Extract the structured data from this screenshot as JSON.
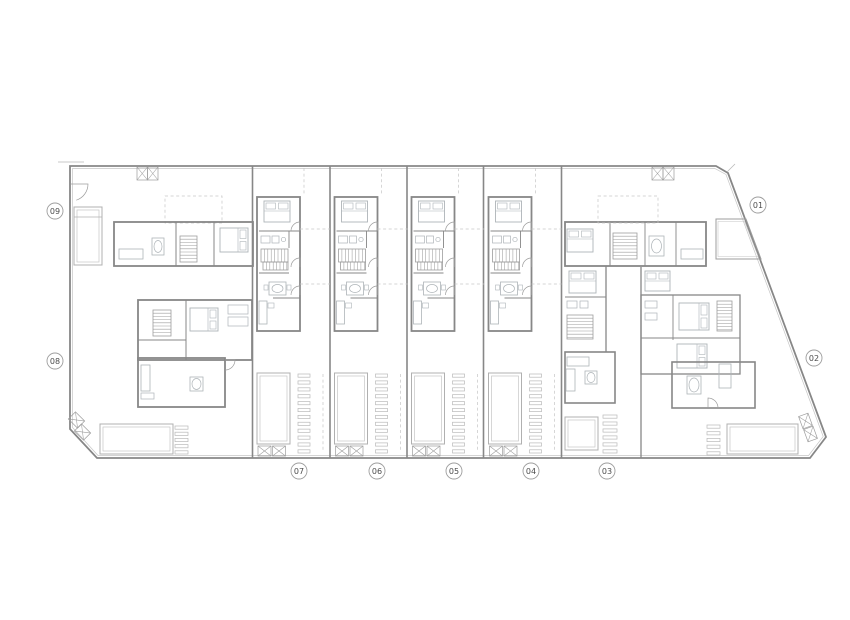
{
  "document": {
    "type": "architectural-floor-plan",
    "description": "Site plan of nine dwellings with pools, circled unit numbers around perimeter"
  },
  "colors": {
    "bg": "#ffffff",
    "W": "#878787",
    "M": "#9d9d9d",
    "L": "#b9b9b9",
    "F": "#aeb4b8",
    "D": "#c6c6c6",
    "P": "#b0b0b0",
    "T": "#4c4c4c"
  },
  "labels": [
    {
      "id": "01",
      "x": 758,
      "y": 205
    },
    {
      "id": "02",
      "x": 814,
      "y": 358
    },
    {
      "id": "03",
      "x": 607,
      "y": 471
    },
    {
      "id": "04",
      "x": 531,
      "y": 471
    },
    {
      "id": "05",
      "x": 454,
      "y": 471
    },
    {
      "id": "06",
      "x": 377,
      "y": 471
    },
    {
      "id": "07",
      "x": 299,
      "y": 471
    },
    {
      "id": "08",
      "x": 55,
      "y": 361
    },
    {
      "id": "09",
      "x": 55,
      "y": 211
    }
  ],
  "plan": {
    "strips": [
      253,
      330.5,
      407.5,
      484.5
    ],
    "statics": [
      {
        "t": "poly",
        "pts": [
          [
            70,
            166
          ],
          [
            716,
            166
          ],
          [
            728,
            173
          ],
          [
            826,
            437
          ],
          [
            810,
            458
          ],
          [
            97,
            458
          ],
          [
            70,
            429
          ]
        ],
        "c": "W",
        "sw": 1.8
      },
      {
        "t": "poly",
        "pts": [
          [
            72.5,
            168.5
          ],
          [
            714.8,
            168.5
          ],
          [
            726,
            174.5
          ],
          [
            823.2,
            436.5
          ],
          [
            808.6,
            455.5
          ],
          [
            98,
            455.5
          ],
          [
            72.5,
            427.5
          ]
        ],
        "c": "D",
        "sw": 0.7
      },
      {
        "t": "line",
        "x1": 58,
        "y1": 162,
        "x2": 84,
        "y2": 162,
        "c": "L",
        "sw": 0.8
      },
      {
        "t": "line",
        "x1": 727,
        "y1": 172,
        "x2": 735,
        "y2": 164,
        "c": "L",
        "sw": 0.8
      },
      {
        "t": "line",
        "x1": 252.5,
        "y1": 166,
        "x2": 252.5,
        "y2": 458,
        "c": "W",
        "sw": 1.6
      },
      {
        "t": "line",
        "x1": 330,
        "y1": 166,
        "x2": 330,
        "y2": 458,
        "c": "W",
        "sw": 1.6
      },
      {
        "t": "line",
        "x1": 407,
        "y1": 166,
        "x2": 407,
        "y2": 458,
        "c": "W",
        "sw": 1.6
      },
      {
        "t": "line",
        "x1": 483.5,
        "y1": 166,
        "x2": 483.5,
        "y2": 458,
        "c": "W",
        "sw": 1.6
      },
      {
        "t": "line",
        "x1": 561.5,
        "y1": 166,
        "x2": 561.5,
        "y2": 458,
        "c": "W",
        "sw": 1.6
      },
      {
        "t": "line",
        "x1": 641,
        "y1": 267,
        "x2": 641,
        "y2": 458,
        "c": "W",
        "sw": 1.3
      },
      {
        "t": "xbox",
        "x": 137,
        "y": 167,
        "w": 10.5,
        "h": 13
      },
      {
        "t": "xbox",
        "x": 147.5,
        "y": 167,
        "w": 10.5,
        "h": 13
      },
      {
        "t": "xbox",
        "x": 652,
        "y": 167,
        "w": 11,
        "h": 13
      },
      {
        "t": "xbox",
        "x": 663,
        "y": 167,
        "w": 11,
        "h": 13
      },
      {
        "t": "pool",
        "x": 74,
        "y": 207,
        "w": 28,
        "h": 58
      },
      {
        "t": "line",
        "x1": 74,
        "y1": 217,
        "x2": 102,
        "y2": 217,
        "c": "P",
        "sw": 0.8
      },
      {
        "t": "door",
        "hx": 71,
        "hy": 184,
        "r": 17,
        "a0": 0,
        "a1": 72,
        "s": 1
      },
      {
        "t": "drect",
        "x": 165,
        "y": 196,
        "w": 57,
        "h": 27
      },
      {
        "t": "rect",
        "x": 114,
        "y": 222,
        "w": 139,
        "h": 44,
        "c": "W",
        "sw": 1.8
      },
      {
        "t": "line",
        "x1": 176,
        "y1": 222,
        "x2": 176,
        "y2": 266,
        "c": "W",
        "sw": 1
      },
      {
        "t": "line",
        "x1": 214,
        "y1": 222,
        "x2": 214,
        "y2": 266,
        "c": "W",
        "sw": 1
      },
      {
        "t": "bed",
        "x": 220,
        "y": 228,
        "w": 28,
        "h": 24,
        "p": "r"
      },
      {
        "t": "hatch",
        "x": 180,
        "y": 236,
        "w": 17,
        "h": 26,
        "step": 3.2,
        "dir": "h"
      },
      {
        "t": "rect",
        "x": 119,
        "y": 249,
        "w": 24,
        "h": 10,
        "c": "F",
        "sw": 0.8
      },
      {
        "t": "rect",
        "x": 152,
        "y": 238,
        "w": 12,
        "h": 17,
        "c": "F",
        "sw": 0.8
      },
      {
        "t": "ell",
        "cx": 158,
        "cy": 246.5,
        "rx": 4,
        "ry": 6,
        "c": "F",
        "sw": 0.7
      },
      {
        "t": "rect",
        "x": 138,
        "y": 300,
        "w": 114,
        "h": 60,
        "c": "W",
        "sw": 1.8
      },
      {
        "t": "rect",
        "x": 138,
        "y": 358,
        "w": 87,
        "h": 49,
        "c": "W",
        "sw": 1.8
      },
      {
        "t": "hatch",
        "x": 153,
        "y": 310,
        "w": 18,
        "h": 26,
        "step": 3.2,
        "dir": "h"
      },
      {
        "t": "bed",
        "x": 190,
        "y": 308,
        "w": 28,
        "h": 23,
        "p": "r"
      },
      {
        "t": "line",
        "x1": 186,
        "y1": 300,
        "x2": 186,
        "y2": 360,
        "c": "W",
        "sw": 1
      },
      {
        "t": "line",
        "x1": 138,
        "y1": 340,
        "x2": 186,
        "y2": 340,
        "c": "W",
        "sw": 1
      },
      {
        "t": "rect",
        "x": 228,
        "y": 305,
        "w": 20,
        "h": 9,
        "c": "F",
        "sw": 0.7
      },
      {
        "t": "rect",
        "x": 228,
        "y": 317,
        "w": 20,
        "h": 9,
        "c": "F",
        "sw": 0.7
      },
      {
        "t": "rect",
        "x": 141,
        "y": 365,
        "w": 9,
        "h": 26,
        "c": "F",
        "sw": 0.8
      },
      {
        "t": "rect",
        "x": 141,
        "y": 393,
        "w": 13,
        "h": 6,
        "c": "F",
        "sw": 0.7
      },
      {
        "t": "rect",
        "x": 190,
        "y": 377,
        "w": 13,
        "h": 14,
        "c": "F",
        "sw": 0.8
      },
      {
        "t": "ell",
        "cx": 196.5,
        "cy": 384,
        "rx": 4.5,
        "ry": 5.5,
        "c": "F",
        "sw": 0.7
      },
      {
        "t": "door",
        "hx": 225,
        "hy": 360,
        "r": 10,
        "a0": 0,
        "a1": 90,
        "s": 1
      },
      {
        "t": "pool",
        "x": 100,
        "y": 424,
        "w": 73,
        "h": 30
      },
      {
        "t": "slats",
        "x": 175,
        "y": 426,
        "w": 13,
        "h": 28,
        "n": 5
      },
      {
        "t": "xbox",
        "x": 70,
        "y": 415,
        "w": 13,
        "h": 10,
        "rot": 45
      },
      {
        "t": "xbox",
        "x": 76,
        "y": 427,
        "w": 13,
        "h": 10,
        "rot": 45
      },
      {
        "t": "rect",
        "x": 565,
        "y": 222,
        "w": 141,
        "h": 44,
        "c": "W",
        "sw": 1.8
      },
      {
        "t": "bed",
        "x": 567,
        "y": 229,
        "w": 26,
        "h": 23,
        "p": "t"
      },
      {
        "t": "line",
        "x1": 610,
        "y1": 222,
        "x2": 610,
        "y2": 266,
        "c": "W",
        "sw": 1
      },
      {
        "t": "hatch",
        "x": 613,
        "y": 233,
        "w": 24,
        "h": 26,
        "step": 3.2,
        "dir": "h"
      },
      {
        "t": "line",
        "x1": 645,
        "y1": 222,
        "x2": 645,
        "y2": 266,
        "c": "W",
        "sw": 0.9
      },
      {
        "t": "rect",
        "x": 649,
        "y": 236,
        "w": 15,
        "h": 20,
        "c": "F",
        "sw": 0.8
      },
      {
        "t": "ell",
        "cx": 656.5,
        "cy": 246,
        "rx": 5,
        "ry": 7,
        "c": "F",
        "sw": 0.7
      },
      {
        "t": "line",
        "x1": 676,
        "y1": 222,
        "x2": 676,
        "y2": 266,
        "c": "W",
        "sw": 0.9
      },
      {
        "t": "rect",
        "x": 681,
        "y": 249,
        "w": 22,
        "h": 10,
        "c": "F",
        "sw": 0.8
      },
      {
        "t": "poly",
        "pts": [
          [
            716,
            219
          ],
          [
            746,
            219
          ],
          [
            761,
            259
          ],
          [
            716,
            259
          ]
        ],
        "c": "M",
        "sw": 1
      },
      {
        "t": "poly",
        "pts": [
          [
            718,
            221.5
          ],
          [
            744.6,
            221.5
          ],
          [
            758.2,
            256.5
          ],
          [
            718,
            256.5
          ]
        ],
        "c": "D",
        "sw": 0.6
      },
      {
        "t": "drect",
        "x": 598,
        "y": 196,
        "w": 60,
        "h": 27
      },
      {
        "t": "line",
        "x1": 606,
        "y1": 266,
        "x2": 606,
        "y2": 352,
        "c": "W",
        "sw": 1.3
      },
      {
        "t": "bed",
        "x": 569,
        "y": 271,
        "w": 27,
        "h": 22,
        "p": "t"
      },
      {
        "t": "line",
        "x1": 565,
        "y1": 297,
        "x2": 606,
        "y2": 297,
        "c": "W",
        "sw": 1
      },
      {
        "t": "rect",
        "x": 567,
        "y": 301,
        "w": 10,
        "h": 7,
        "c": "F",
        "sw": 0.7
      },
      {
        "t": "rect",
        "x": 580,
        "y": 301,
        "w": 8,
        "h": 7,
        "c": "F",
        "sw": 0.7
      },
      {
        "t": "hatch",
        "x": 567,
        "y": 315,
        "w": 26,
        "h": 24,
        "step": 3.2,
        "dir": "h"
      },
      {
        "t": "rect",
        "x": 565,
        "y": 352,
        "w": 50,
        "h": 51,
        "c": "W",
        "sw": 1.6
      },
      {
        "t": "rect",
        "x": 567,
        "y": 357,
        "w": 22,
        "h": 9,
        "c": "F",
        "sw": 0.8
      },
      {
        "t": "rect",
        "x": 566,
        "y": 369,
        "w": 9,
        "h": 22,
        "c": "F",
        "sw": 0.8
      },
      {
        "t": "rect",
        "x": 585,
        "y": 371,
        "w": 12,
        "h": 13,
        "c": "F",
        "sw": 0.8
      },
      {
        "t": "ell",
        "cx": 591,
        "cy": 377.5,
        "rx": 4,
        "ry": 5,
        "c": "F",
        "sw": 0.7
      },
      {
        "t": "rect",
        "x": 641,
        "y": 295,
        "w": 99,
        "h": 79,
        "c": "W",
        "sw": 1.3
      },
      {
        "t": "bed",
        "x": 645,
        "y": 271,
        "w": 25,
        "h": 20,
        "p": "t"
      },
      {
        "t": "line",
        "x1": 673,
        "y1": 295,
        "x2": 673,
        "y2": 340,
        "c": "W",
        "sw": 0.9
      },
      {
        "t": "line",
        "x1": 641,
        "y1": 338,
        "x2": 740,
        "y2": 338,
        "c": "W",
        "sw": 0.9
      },
      {
        "t": "bed",
        "x": 679,
        "y": 303,
        "w": 30,
        "h": 27,
        "p": "r"
      },
      {
        "t": "bed",
        "x": 677,
        "y": 344,
        "w": 30,
        "h": 24,
        "p": "r"
      },
      {
        "t": "hatch",
        "x": 717,
        "y": 301,
        "w": 15,
        "h": 30,
        "step": 3.2,
        "dir": "h"
      },
      {
        "t": "rect",
        "x": 645,
        "y": 301,
        "w": 12,
        "h": 7,
        "c": "F",
        "sw": 0.7
      },
      {
        "t": "rect",
        "x": 645,
        "y": 313,
        "w": 12,
        "h": 7,
        "c": "F",
        "sw": 0.7
      },
      {
        "t": "rect",
        "x": 672,
        "y": 362,
        "w": 83,
        "h": 46,
        "c": "W",
        "sw": 1.6
      },
      {
        "t": "rect",
        "x": 687,
        "y": 376,
        "w": 14,
        "h": 18,
        "c": "F",
        "sw": 0.8
      },
      {
        "t": "ell",
        "cx": 694,
        "cy": 385,
        "rx": 5,
        "ry": 7,
        "c": "F",
        "sw": 0.7
      },
      {
        "t": "rect",
        "x": 719,
        "y": 364,
        "w": 12,
        "h": 24,
        "c": "F",
        "sw": 0.8
      },
      {
        "t": "door",
        "hx": 708,
        "hy": 408,
        "r": 10,
        "a0": -90,
        "a1": 0,
        "s": 1
      },
      {
        "t": "pool",
        "x": 565,
        "y": 417,
        "w": 33,
        "h": 33
      },
      {
        "t": "slats",
        "x": 603,
        "y": 415,
        "w": 14,
        "h": 38,
        "n": 6
      },
      {
        "t": "slats",
        "x": 707,
        "y": 425,
        "w": 13,
        "h": 30,
        "n": 5
      },
      {
        "t": "pool",
        "x": 727,
        "y": 424,
        "w": 71,
        "h": 30
      },
      {
        "t": "xbox",
        "x": 799,
        "y": 416,
        "w": 13,
        "h": 10,
        "rot": 70
      },
      {
        "t": "xbox",
        "x": 804,
        "y": 429,
        "w": 13,
        "h": 10,
        "rot": 70
      }
    ],
    "unit": [
      {
        "t": "rect",
        "x": 4,
        "y": 197,
        "w": 43,
        "h": 134,
        "c": "W",
        "sw": 1.8
      },
      {
        "t": "line",
        "x1": 6,
        "y1": 231,
        "x2": 47,
        "y2": 231,
        "c": "W",
        "sw": 1.1
      },
      {
        "t": "line",
        "x1": 6,
        "y1": 273,
        "x2": 36,
        "y2": 273,
        "c": "W",
        "sw": 0.9
      },
      {
        "t": "line",
        "x1": 20,
        "y1": 298,
        "x2": 47,
        "y2": 298,
        "c": "W",
        "sw": 0.9
      },
      {
        "t": "line",
        "x1": 36,
        "y1": 231,
        "x2": 36,
        "y2": 248,
        "c": "W",
        "sw": 0.9
      },
      {
        "t": "bed",
        "x": 11,
        "y": 201,
        "w": 26,
        "h": 21,
        "p": "t"
      },
      {
        "t": "rect",
        "x": 8,
        "y": 236,
        "w": 9,
        "h": 7,
        "c": "F",
        "sw": 0.7
      },
      {
        "t": "rect",
        "x": 19,
        "y": 236,
        "w": 7,
        "h": 7,
        "c": "F",
        "sw": 0.7
      },
      {
        "t": "circ",
        "cx": 30.5,
        "cy": 239.5,
        "r": 2.2,
        "c": "F",
        "sw": 0.7
      },
      {
        "t": "hatch",
        "x": 8,
        "y": 249,
        "w": 27,
        "h": 13,
        "step": 3.4,
        "dir": "v"
      },
      {
        "t": "hatch",
        "x": 10,
        "y": 262,
        "w": 25,
        "h": 8,
        "step": 3.4,
        "dir": "v"
      },
      {
        "t": "rect",
        "x": 16,
        "y": 282,
        "w": 17,
        "h": 13,
        "c": "F",
        "sw": 0.8
      },
      {
        "t": "ell",
        "cx": 24.5,
        "cy": 288.5,
        "rx": 5.5,
        "ry": 4,
        "c": "F",
        "sw": 0.7
      },
      {
        "t": "rect",
        "x": 11,
        "y": 285,
        "w": 4,
        "h": 5,
        "c": "F",
        "sw": 0.6
      },
      {
        "t": "rect",
        "x": 34,
        "y": 285,
        "w": 4,
        "h": 5,
        "c": "F",
        "sw": 0.6
      },
      {
        "t": "rect",
        "x": 6,
        "y": 301,
        "w": 8,
        "h": 23,
        "c": "F",
        "sw": 0.8
      },
      {
        "t": "rect",
        "x": 15,
        "y": 303,
        "w": 6,
        "h": 5,
        "c": "F",
        "sw": 0.6
      },
      {
        "t": "door",
        "hx": 47,
        "hy": 231,
        "r": 9,
        "a0": -90,
        "a1": 180,
        "s": 0
      },
      {
        "t": "door",
        "hx": 47,
        "hy": 267,
        "r": 9,
        "a0": -90,
        "a1": 180,
        "s": 0
      },
      {
        "t": "door",
        "hx": 47,
        "hy": 295,
        "r": 9,
        "a0": -90,
        "a1": 180,
        "s": 0
      },
      {
        "t": "line",
        "x1": 47,
        "y1": 229,
        "x2": 77,
        "y2": 229,
        "c": "D",
        "sw": 0.7,
        "d": 1
      },
      {
        "t": "line",
        "x1": 47,
        "y1": 284,
        "x2": 77,
        "y2": 284,
        "c": "D",
        "sw": 0.7,
        "d": 1
      },
      {
        "t": "line",
        "x1": 51,
        "y1": 168,
        "x2": 51,
        "y2": 196,
        "c": "D",
        "sw": 0.7,
        "d": 1
      },
      {
        "t": "pool",
        "x": 4,
        "y": 373,
        "w": 33,
        "h": 71
      },
      {
        "t": "slats",
        "x": 45,
        "y": 374,
        "w": 12,
        "h": 79,
        "n": 12
      },
      {
        "t": "line",
        "x1": 70,
        "y1": 374,
        "x2": 70,
        "y2": 452,
        "c": "D",
        "sw": 0.7,
        "d": 1
      },
      {
        "t": "xbox",
        "x": 5,
        "y": 446,
        "w": 13,
        "h": 10
      },
      {
        "t": "xbox",
        "x": 19.5,
        "y": 446,
        "w": 13,
        "h": 10
      }
    ]
  }
}
